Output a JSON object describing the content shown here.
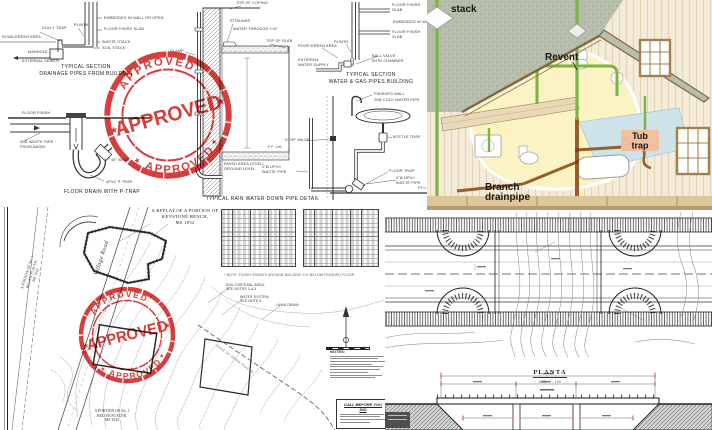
{
  "stamp": {
    "top_text": "APPROVED",
    "center_text": "APPROVED",
    "bottom_text": "APPROVED",
    "star": "★",
    "color": "#d3302f"
  },
  "colors": {
    "stamp_red": "#d3302f",
    "pipe_green": "#7cb342",
    "drain_brown": "#9a5d28",
    "roof_gray_green": "#b7beac",
    "wall_cream": "#f4ecd8",
    "tub_label_bg": "#f2c09c",
    "bath_floor_blue": "#cde3ea"
  },
  "plumbing": {
    "captions": {
      "drainage": "TYPICAL SECTION\nDRAINAGE PIPES FROM BUILDING",
      "floor_drain": "FLOOR DRAIN WITH P-TRAP",
      "rain": "TYPICAL RAIN WATER DOWN PIPE DETAIL",
      "watergas": "TYPICAL SECTION\nWATER & GAS PIPES BUILDING"
    },
    "labels": {
      "road_green": "ROAD/GREEN AREA",
      "gully_trap": "GULLY TRAP",
      "plinth_a": "PLINTH",
      "manhole": "MANHOLE",
      "ext_sewer": "EXTERNAL SEWER",
      "embedded_a": "EMBEDDED IN WALL OR OPEN",
      "ffs_a": "FLOOR FINISH SLAB",
      "waste_stack": "WASTE STACK",
      "soil_stack": "SOIL STACK",
      "floor_finish": "FLOOR FINISH",
      "waste_basin": "40Ø WASTE PIPE\nFROM BASIN",
      "bend45": "45° BEND",
      "ptrap": "uPVC P-TRAP",
      "coping": "TOP OF COPING",
      "strainer": "STRAINER",
      "water_through": "WATER THROUGH 2'x2'",
      "top_slab": "TOP OF SLAB",
      "clamp": "CLAMP",
      "fflvl": "F.F. LVL",
      "paved": "PAVED AREA LEVEL/\nGROUND LEVEL",
      "plinth_b": "PLINTH",
      "roof_green_b": "ROOF/GREEN AREA",
      "ext_water": "EXTERNAL\nWATER SUPPLY",
      "ball_valve": "BALL VALVE\nWITH CHAMBER",
      "ffs_b1": "FLOOR FINISH\nSLAB",
      "embedded_b": "EMBEDDED IN WALL",
      "ffs_b2": "FLOOR FINISH\nSLAB",
      "finished_wall": "FINISHED WALL",
      "cold_pipe": "20Ø COLD WATER PIPE",
      "stop_valve": "STOP VALVE",
      "bottle_trap": "BOTTLE TRAP",
      "floor_trap": "FLOOR TRAP",
      "waste_e": "2\"Ø UPVC\nWASTE PIPE",
      "waste_w": "2\"Ø UPVC\nWASTE PIPE",
      "ffl": "F.F.L."
    }
  },
  "house": {
    "labels": {
      "stack": "stack",
      "revent": "Revent",
      "tub1": "Tub",
      "tub2": "trap",
      "branch1": "Branch",
      "branch2": "drainpipe"
    }
  },
  "siteplan": {
    "title": "A REPLAT OF A PORTION OF\nKEYSTONE BENCH,\nMS 1052",
    "village_road": "Village Road",
    "parcel_left": "A PORTION OF No. 1\nBELOW PLACER,\nMS 1043",
    "parcel_bottom": "A PORTION OF No. 1\nBELOW PLACER,\nMS 1042",
    "soil": "SOIL DISPOSAL AREA,\nSEE NOTES 3 & 4",
    "water": "WATER SYSTEM,\nSEE NOTE 5",
    "lawn": "LAWN DRAIN",
    "creek": "EDGE OF CREEK PLACER",
    "table_note": "* NOTE: FINISH GRADES AROUND BUILDING 0.5' BELOW FINISHED FLOOR",
    "notes_title": "NOTES:",
    "call_title": "CALL BEFORE YOU DIG",
    "survey_table": {
      "blocks": 2,
      "rows": 13,
      "columns": 5
    }
  },
  "bridge": {
    "plan_label": "PLANTA",
    "plan_scale": "ESC. 1 : 100"
  }
}
